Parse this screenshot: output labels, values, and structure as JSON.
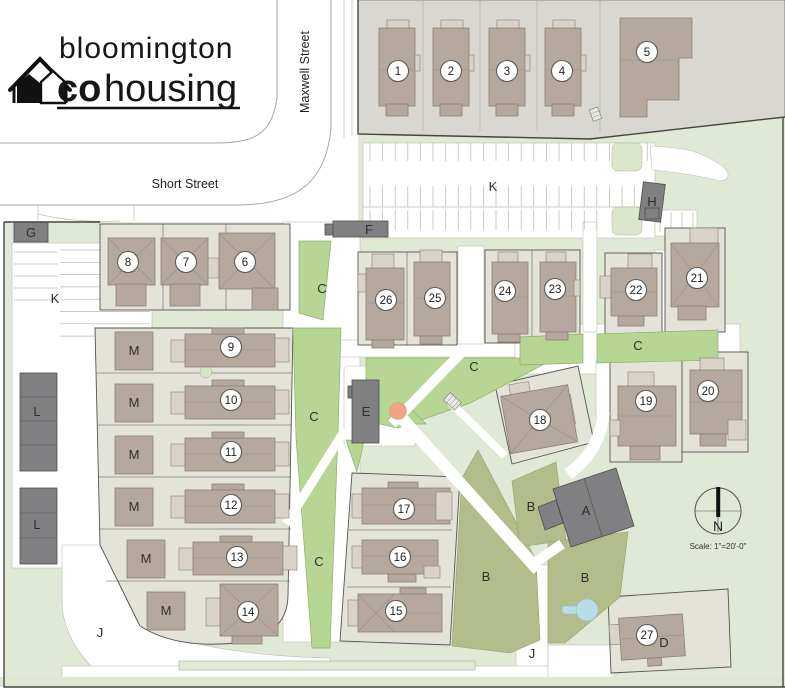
{
  "logo": {
    "line1": "bloomington",
    "co": "co",
    "housing": "housing"
  },
  "streets": {
    "short": "Short Street",
    "maxwell": "Maxwell Street"
  },
  "compass": {
    "north": "N",
    "scale": "Scale: 1\"=20'-0\""
  },
  "colors": {
    "site_green": "#e0e8d6",
    "common_green": "#b7d694",
    "garden_olive": "#b3bd8c",
    "lot_gray": "#e4e3da",
    "parcel_gray": "#d9d7d1",
    "house_taupe": "#b5a99f",
    "building_dark": "#808083",
    "pond_blue": "#b9dde7",
    "tree_orange": "#f0a487"
  },
  "houses": [
    {
      "n": "1",
      "x": 398,
      "y": 71
    },
    {
      "n": "2",
      "x": 451,
      "y": 71
    },
    {
      "n": "3",
      "x": 507,
      "y": 71
    },
    {
      "n": "4",
      "x": 562,
      "y": 71
    },
    {
      "n": "5",
      "x": 647,
      "y": 52
    },
    {
      "n": "6",
      "x": 245,
      "y": 262
    },
    {
      "n": "7",
      "x": 186,
      "y": 262
    },
    {
      "n": "8",
      "x": 128,
      "y": 262
    },
    {
      "n": "9",
      "x": 231,
      "y": 347
    },
    {
      "n": "10",
      "x": 231,
      "y": 400
    },
    {
      "n": "11",
      "x": 231,
      "y": 452
    },
    {
      "n": "12",
      "x": 231,
      "y": 505
    },
    {
      "n": "13",
      "x": 237,
      "y": 557
    },
    {
      "n": "14",
      "x": 248,
      "y": 612
    },
    {
      "n": "15",
      "x": 396,
      "y": 611
    },
    {
      "n": "16",
      "x": 400,
      "y": 557
    },
    {
      "n": "17",
      "x": 404,
      "y": 509
    },
    {
      "n": "18",
      "x": 540,
      "y": 420
    },
    {
      "n": "19",
      "x": 646,
      "y": 401
    },
    {
      "n": "20",
      "x": 708,
      "y": 391
    },
    {
      "n": "21",
      "x": 697,
      "y": 278
    },
    {
      "n": "22",
      "x": 636,
      "y": 290
    },
    {
      "n": "23",
      "x": 555,
      "y": 289
    },
    {
      "n": "24",
      "x": 505,
      "y": 291
    },
    {
      "n": "25",
      "x": 435,
      "y": 298
    },
    {
      "n": "26",
      "x": 386,
      "y": 300
    },
    {
      "n": "27",
      "x": 647,
      "y": 635
    }
  ],
  "area_labels": [
    {
      "t": "K",
      "x": 493,
      "y": 191
    },
    {
      "t": "K",
      "x": 55,
      "y": 303
    },
    {
      "t": "G",
      "x": 31,
      "y": 237
    },
    {
      "t": "F",
      "x": 369,
      "y": 234
    },
    {
      "t": "H",
      "x": 652,
      "y": 206,
      "light": true
    },
    {
      "t": "L",
      "x": 37,
      "y": 416
    },
    {
      "t": "L",
      "x": 37,
      "y": 529
    },
    {
      "t": "M",
      "x": 134,
      "y": 355
    },
    {
      "t": "M",
      "x": 134,
      "y": 407
    },
    {
      "t": "M",
      "x": 134,
      "y": 459
    },
    {
      "t": "M",
      "x": 134,
      "y": 511
    },
    {
      "t": "M",
      "x": 146,
      "y": 563
    },
    {
      "t": "M",
      "x": 166,
      "y": 615
    },
    {
      "t": "C",
      "x": 322,
      "y": 293
    },
    {
      "t": "C",
      "x": 314,
      "y": 421
    },
    {
      "t": "C",
      "x": 474,
      "y": 371
    },
    {
      "t": "C",
      "x": 638,
      "y": 350
    },
    {
      "t": "C",
      "x": 319,
      "y": 566
    },
    {
      "t": "B",
      "x": 531,
      "y": 511
    },
    {
      "t": "B",
      "x": 486,
      "y": 581
    },
    {
      "t": "B",
      "x": 585,
      "y": 582
    },
    {
      "t": "E",
      "x": 366,
      "y": 416
    },
    {
      "t": "A",
      "x": 586,
      "y": 515
    },
    {
      "t": "D",
      "x": 664,
      "y": 647
    },
    {
      "t": "J",
      "x": 100,
      "y": 637
    },
    {
      "t": "J",
      "x": 532,
      "y": 658
    }
  ]
}
